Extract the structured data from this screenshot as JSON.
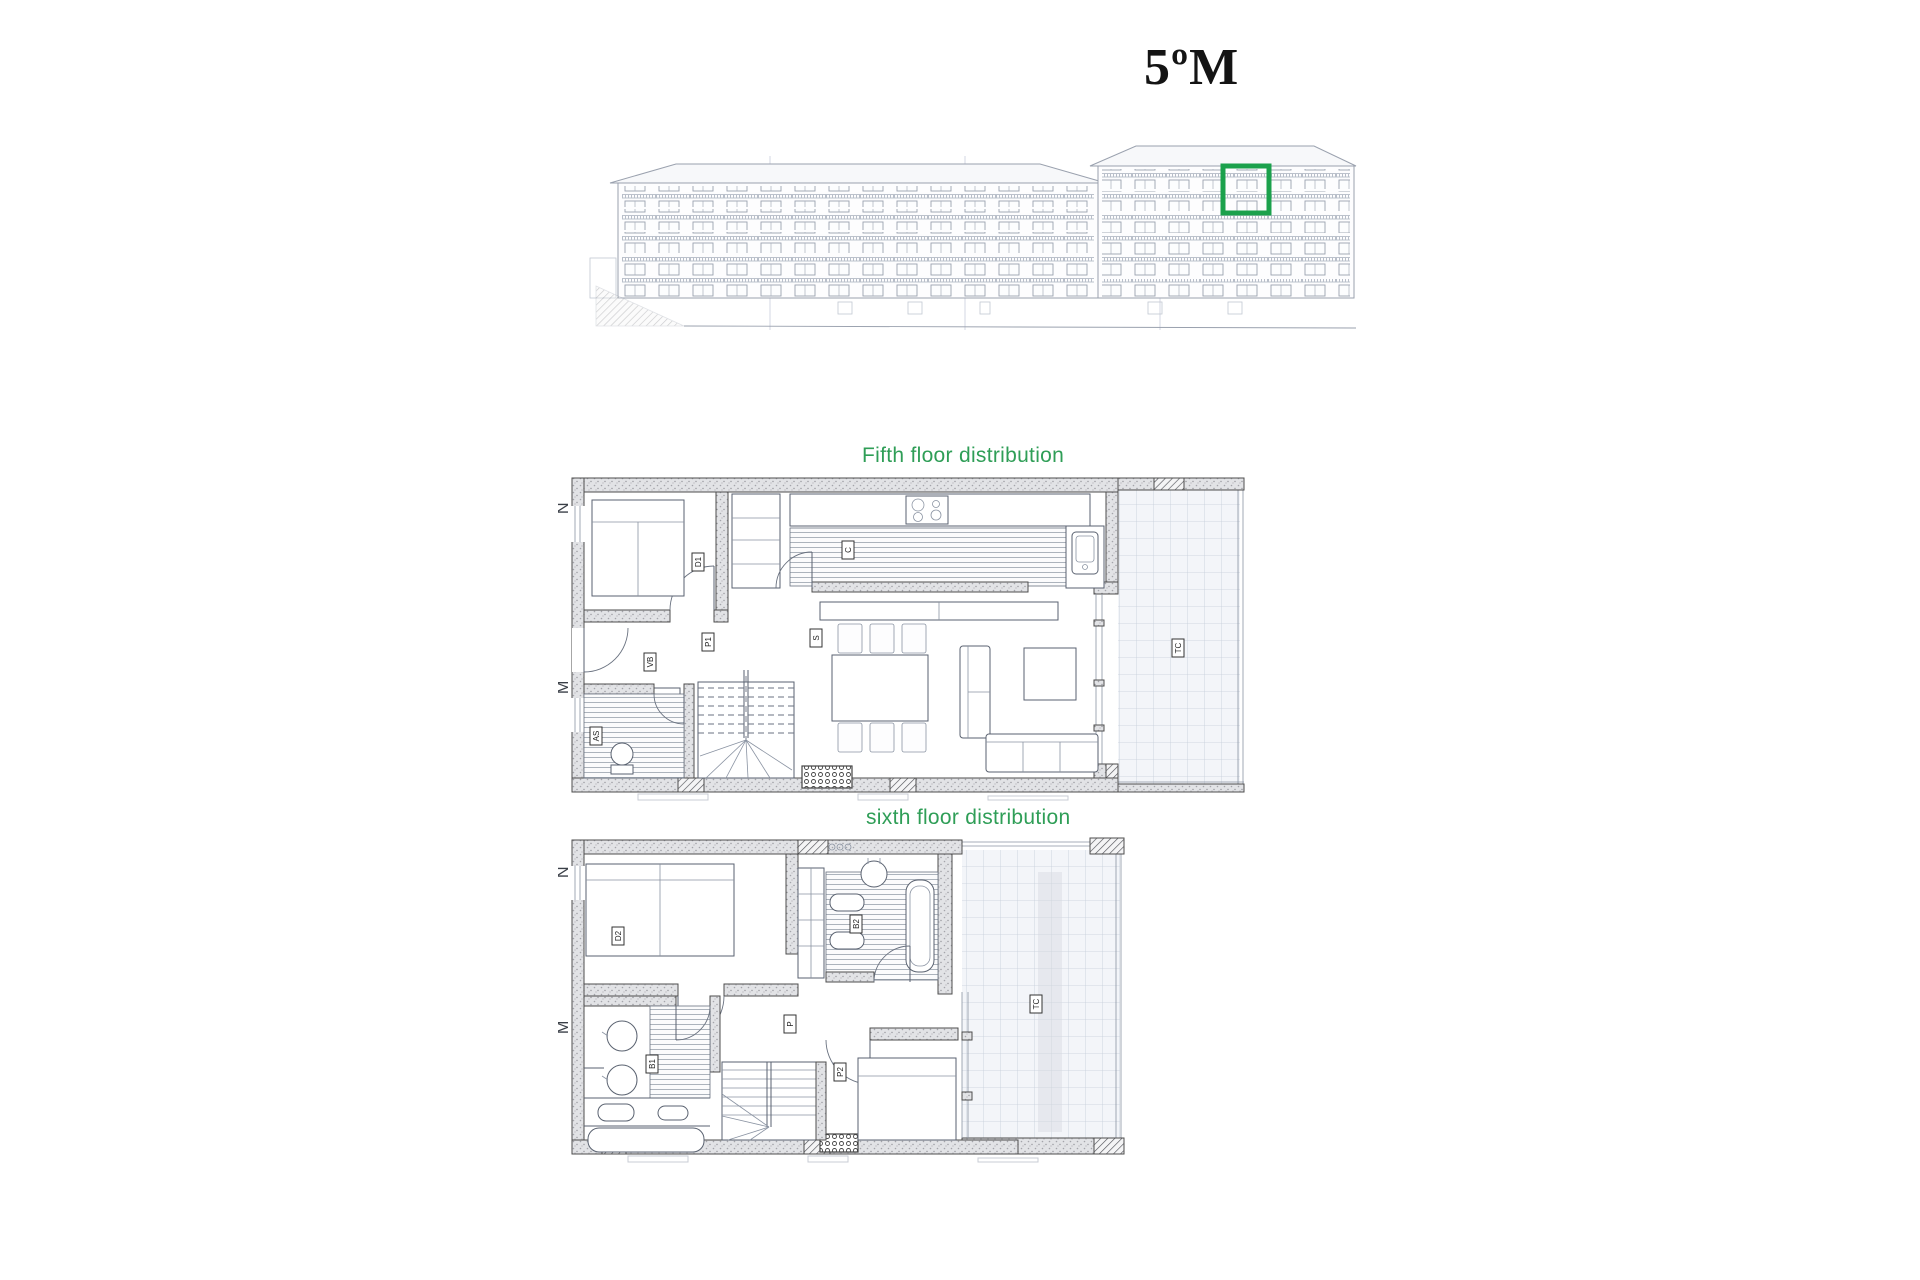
{
  "title": {
    "text": "5ºM"
  },
  "colors": {
    "accent_green": "#2f9e57",
    "highlight_box_green": "#1ba14c",
    "elevation_line": "#9aa1ae",
    "wall_line": "#4d4d4d"
  },
  "elevation": {
    "description": "building front elevation",
    "main_block_floor_rows": 5,
    "tower_floor_rows": 6,
    "highlighted_unit_floors": 2
  },
  "plans": {
    "fifth": {
      "heading": "Fifth floor distribution",
      "labels": {
        "north": "N",
        "wall": "M",
        "bedroom": "D1",
        "kitchen": "C",
        "hall": "P1",
        "entry": "VB",
        "living": "S",
        "wc": "AS",
        "terrace": "TC"
      }
    },
    "sixth": {
      "heading": "sixth floor distribution",
      "labels": {
        "north": "N",
        "wall": "M",
        "bedroom1": "D2",
        "bath2": "B2",
        "hall": "P",
        "bath1": "B1",
        "bedroom2": "P2",
        "terrace": "TC"
      }
    }
  }
}
